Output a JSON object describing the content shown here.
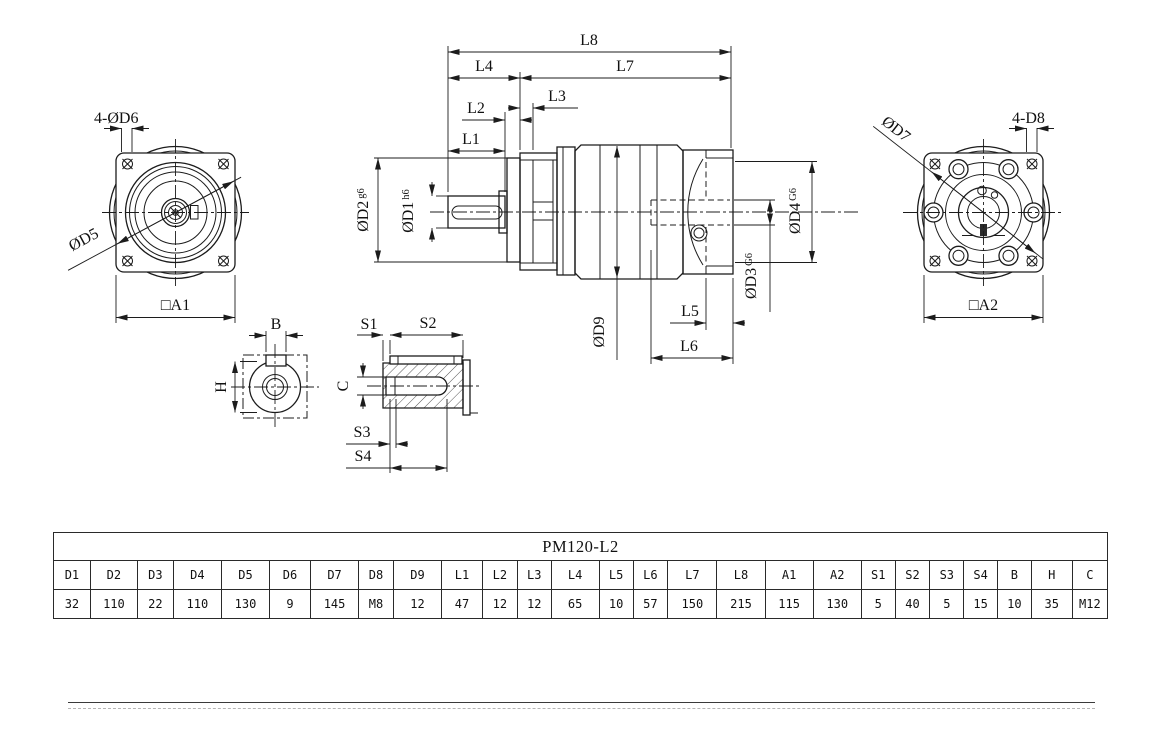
{
  "drawing": {
    "front_view": {
      "bolt_note": "4-ØD6",
      "d5": "ØD5",
      "a1": "□A1"
    },
    "side_view": {
      "l1": "L1",
      "l2": "L2",
      "l3": "L3",
      "l4": "L4",
      "l5": "L5",
      "l6": "L6",
      "l7": "L7",
      "l8": "L8",
      "d1": "ØD1",
      "d1_tol": "h6",
      "d2": "ØD2",
      "d2_tol": "g6",
      "d3": "ØD3",
      "d3_tol": "G6",
      "d4": "ØD4",
      "d4_tol": "G6",
      "d9": "ØD9"
    },
    "rear_view": {
      "d7": "ØD7",
      "bolt_note": "4-D8",
      "a2": "□A2"
    },
    "shaft_end_view": {
      "b": "B",
      "h": "H"
    },
    "key_view": {
      "s1": "S1",
      "s2": "S2",
      "s3": "S3",
      "s4": "S4",
      "c": "C"
    },
    "line_color": "#1c1c1c"
  },
  "table": {
    "title": "PM120-L2",
    "headers": [
      "D1",
      "D2",
      "D3",
      "D4",
      "D5",
      "D6",
      "D7",
      "D8",
      "D9",
      "L1",
      "L2",
      "L3",
      "L4",
      "L5",
      "L6",
      "L7",
      "L8",
      "A1",
      "A2",
      "S1",
      "S2",
      "S3",
      "S4",
      "B",
      "H",
      "C"
    ],
    "values": [
      "32",
      "110",
      "22",
      "110",
      "130",
      "9",
      "145",
      "M8",
      "12",
      "47",
      "12",
      "12",
      "65",
      "10",
      "57",
      "150",
      "215",
      "115",
      "130",
      "5",
      "40",
      "5",
      "15",
      "10",
      "35",
      "M12"
    ]
  }
}
